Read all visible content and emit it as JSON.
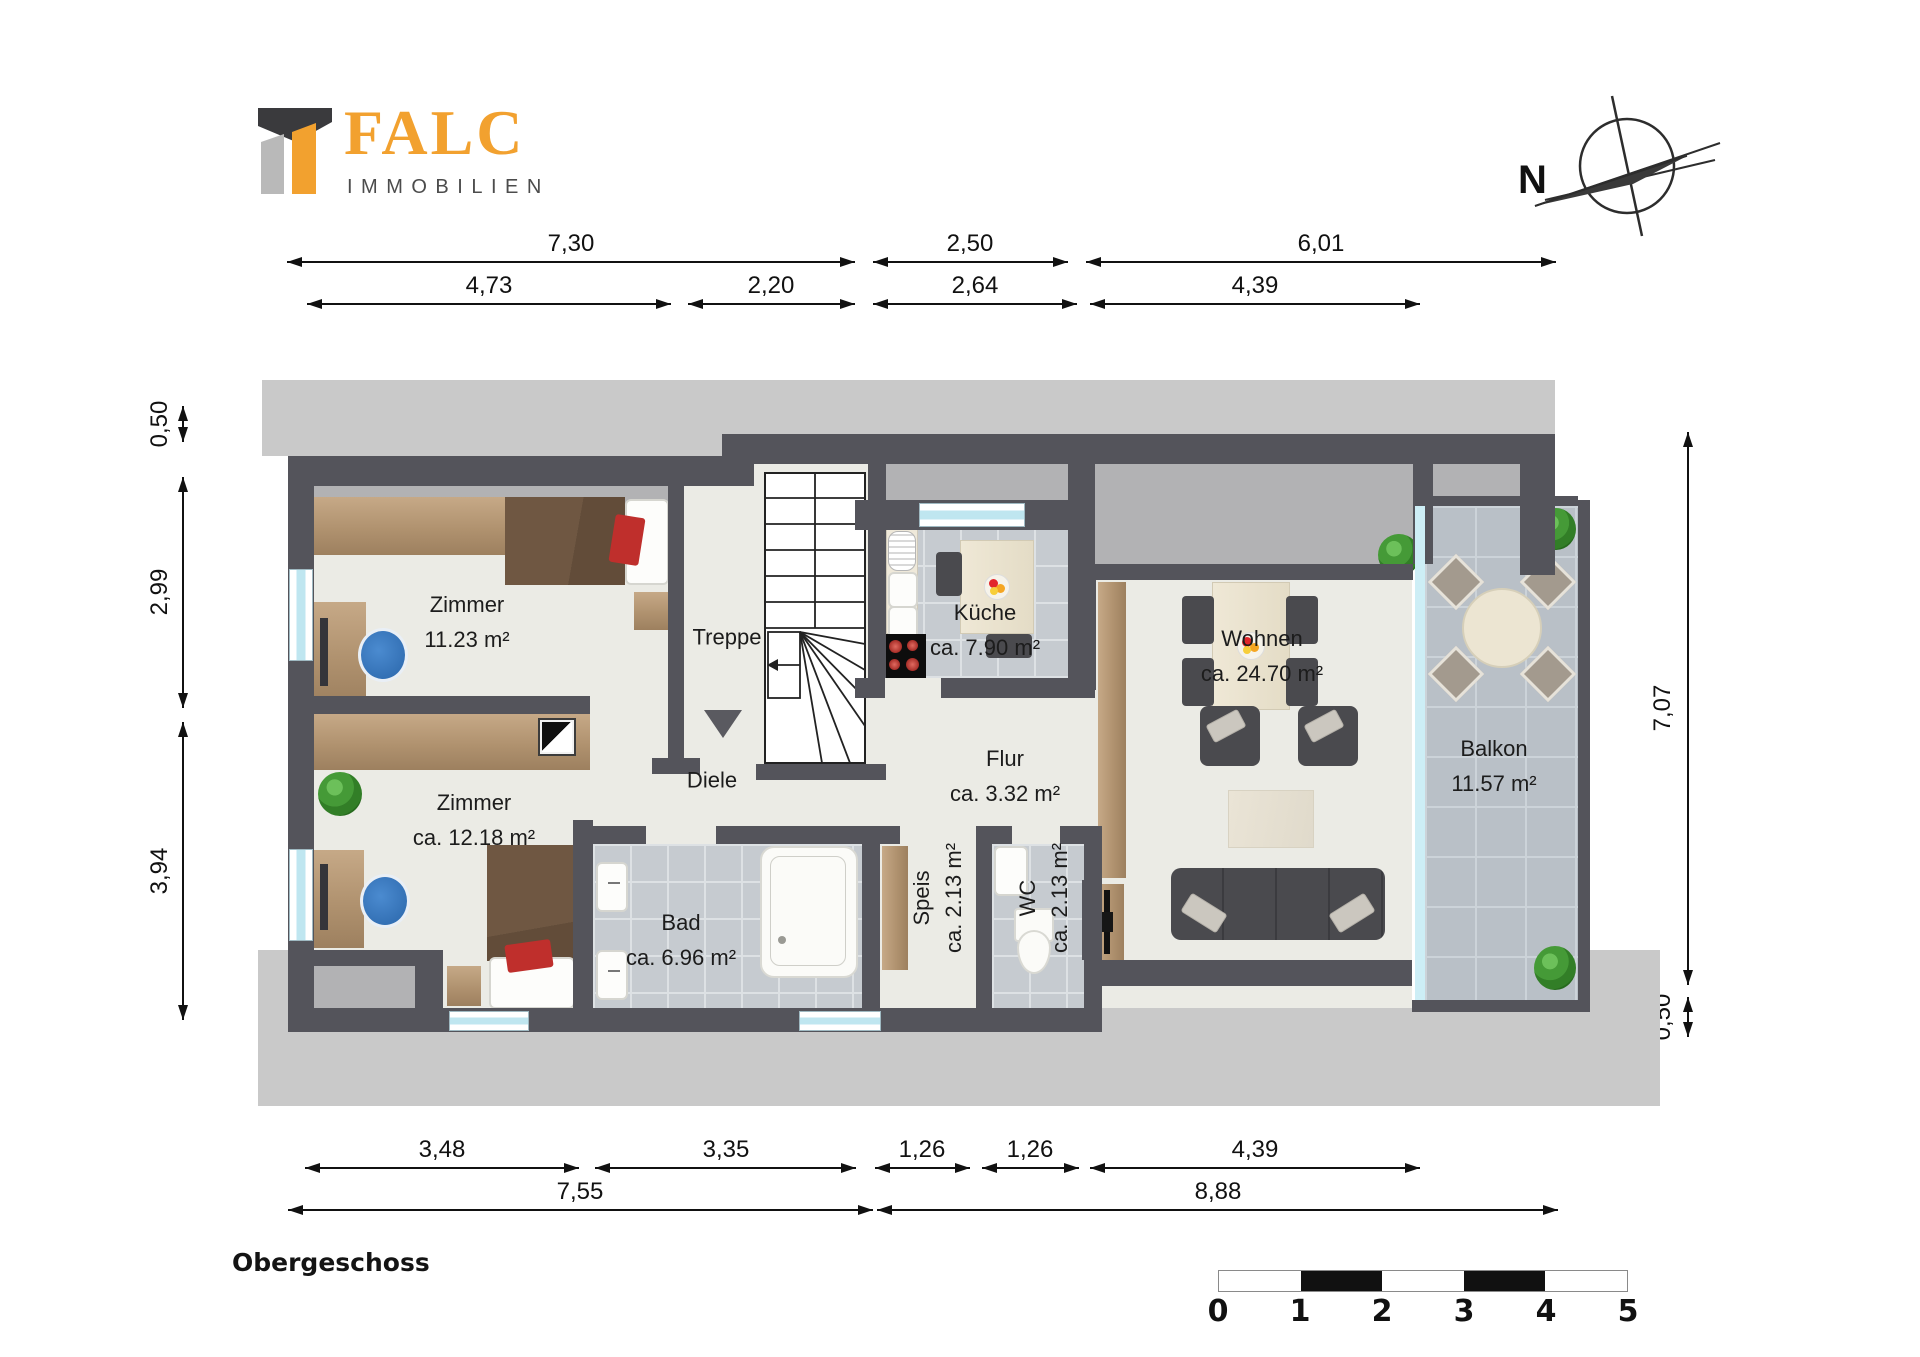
{
  "brand": {
    "name": "FALC",
    "subtitle": "IMMOBILIEN"
  },
  "compass": {
    "north_label": "N"
  },
  "floor_title": "Obergeschoss",
  "rooms": {
    "zimmer1": {
      "name": "Zimmer",
      "area": "11.23 m²"
    },
    "zimmer2": {
      "name": "Zimmer",
      "area": "ca. 12.18 m²"
    },
    "treppe": {
      "name": "Treppe"
    },
    "diele": {
      "name": "Diele"
    },
    "kueche": {
      "name": "Küche",
      "area": "ca. 7.90 m²"
    },
    "flur": {
      "name": "Flur",
      "area": "ca. 3.32 m²"
    },
    "wohnen": {
      "name": "Wohnen",
      "area": "ca. 24.70 m²"
    },
    "balkon": {
      "name": "Balkon",
      "area": "11.57 m²"
    },
    "bad": {
      "name": "Bad",
      "area": "ca. 6.96 m²"
    },
    "speis": {
      "name": "Speis",
      "area": "ca. 2.13 m²"
    },
    "wc": {
      "name": "WC",
      "area": "ca. 2.13 m²"
    }
  },
  "dimensions": {
    "top_row1": [
      "7,30",
      "2,50",
      "6,01"
    ],
    "top_row2": [
      "4,73",
      "2,20",
      "2,64",
      "4,39"
    ],
    "left": [
      "0,50",
      "2,99",
      "3,94"
    ],
    "right": [
      "7,07",
      "0,50"
    ],
    "bottom_row1": [
      "3,48",
      "3,35",
      "1,26",
      "1,26",
      "4,39"
    ],
    "bottom_row2": [
      "7,55",
      "8,88"
    ]
  },
  "scale_bar": {
    "ticks": [
      "0",
      "1",
      "2",
      "3",
      "4",
      "5"
    ]
  },
  "colors": {
    "wall": "#54545b",
    "backdrop": "#c9c9c9",
    "roof_strip": "#b2b2b4",
    "floor": "#ebebe5",
    "tile": "#c6cbd0",
    "balcony_tile": "#b9c0c7",
    "brand_orange": "#f2a12f",
    "accent_red": "#bf2f2c",
    "chair_blue": "#2f72bb"
  }
}
